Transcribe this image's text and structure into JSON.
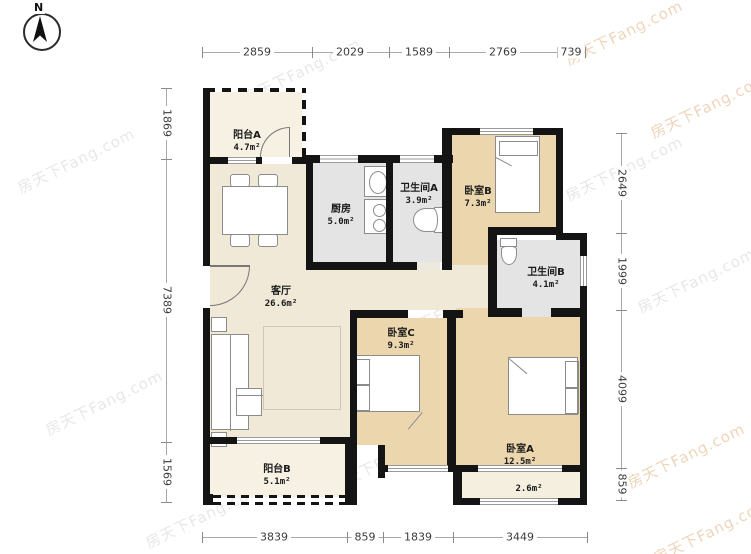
{
  "compass": {
    "label": "N"
  },
  "watermark": {
    "text": "房天下Fang.com"
  },
  "rooms": {
    "balcony_a": {
      "name": "阳台A",
      "area": "4.7m²"
    },
    "kitchen": {
      "name": "厨房",
      "area": "5.0m²"
    },
    "bath_a": {
      "name": "卫生间A",
      "area": "3.9m²"
    },
    "bedroom_b": {
      "name": "卧室B",
      "area": "7.3m²"
    },
    "bath_b": {
      "name": "卫生间B",
      "area": "4.1m²"
    },
    "living": {
      "name": "客厅",
      "area": "26.6m²"
    },
    "bedroom_c": {
      "name": "卧室C",
      "area": "9.3m²"
    },
    "bedroom_a": {
      "name": "卧室A",
      "area": "12.5m²"
    },
    "balcony_b": {
      "name": "阳台B",
      "area": "5.1m²"
    },
    "bay": {
      "area": "2.6m²"
    }
  },
  "dimensions": {
    "top": [
      "2859",
      "2029",
      "1589",
      "2769",
      "739"
    ],
    "bottom": [
      "3839",
      "859",
      "1839",
      "3449"
    ],
    "left": [
      "1869",
      "7389",
      "1569"
    ],
    "right": [
      "2649",
      "1999",
      "4099",
      "859"
    ]
  },
  "colors": {
    "wall": "#141414",
    "room_cream": "#f0e9d8",
    "room_light": "#f6f1e3",
    "room_tan": "#ebd6ae",
    "room_gray": "#e4e4e4",
    "window": "#9a9a9a",
    "watermark_orange": "#d69858"
  }
}
